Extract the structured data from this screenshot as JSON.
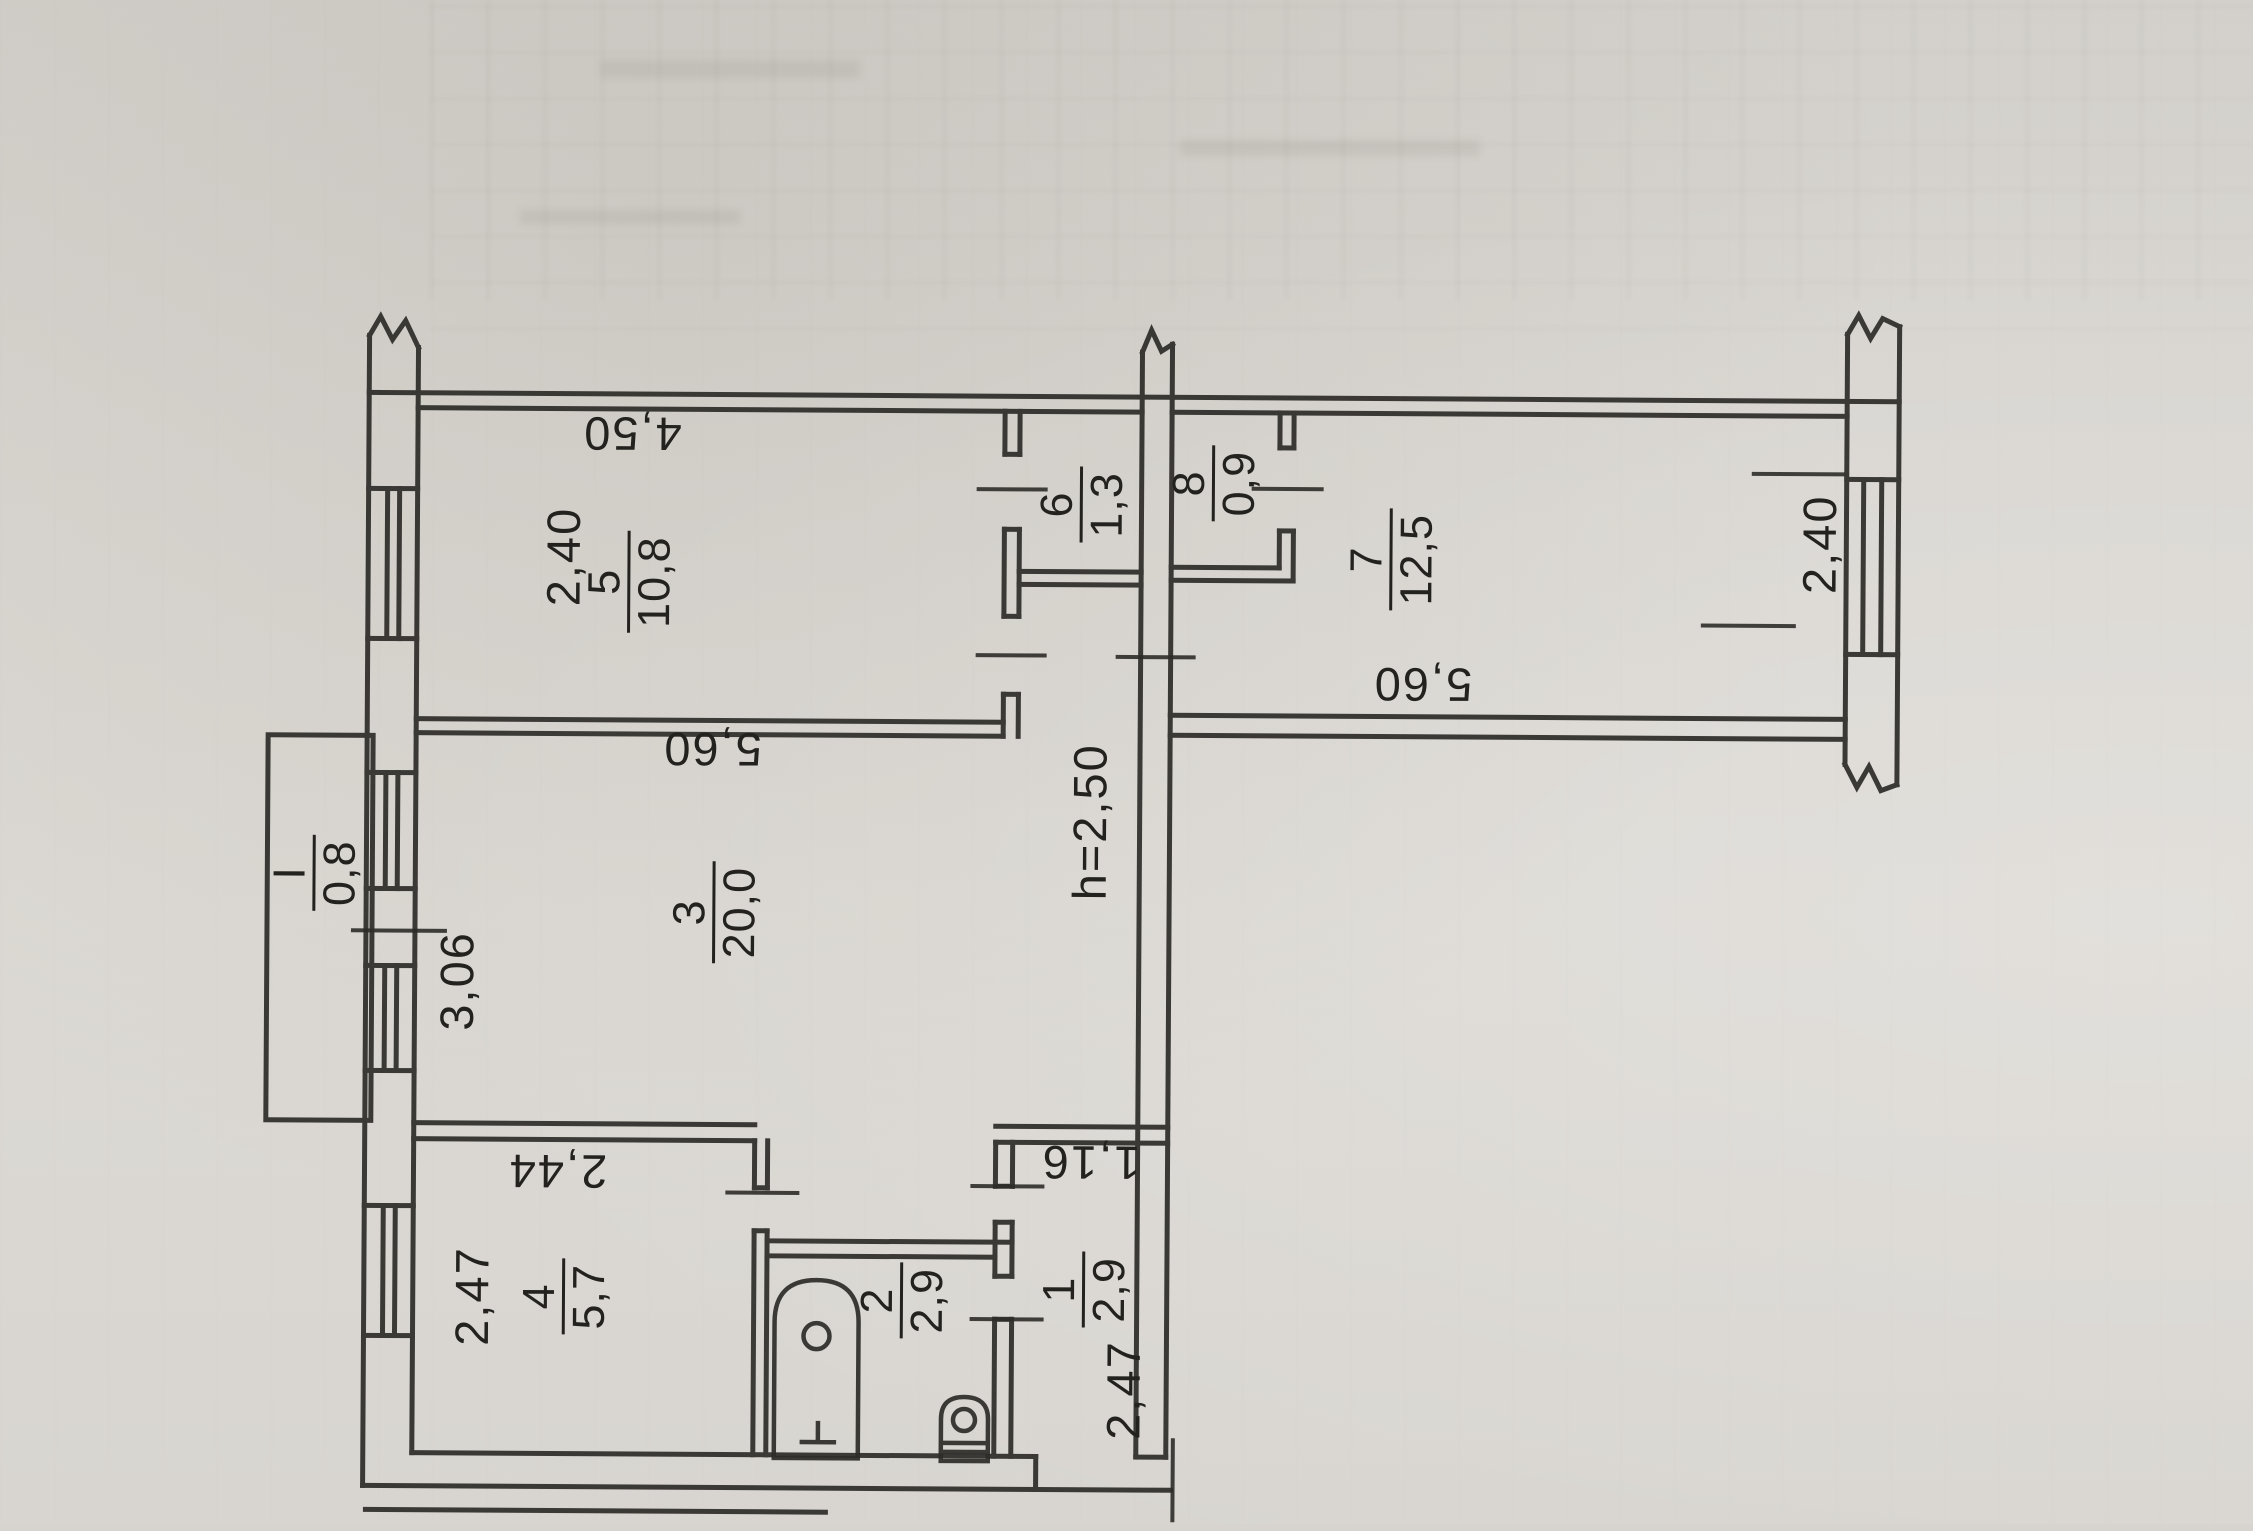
{
  "plan": {
    "rooms": [
      {
        "num": "5",
        "area": "10,8"
      },
      {
        "num": "6",
        "area": "1,3"
      },
      {
        "num": "8",
        "area": "0,9"
      },
      {
        "num": "7",
        "area": "12,5"
      },
      {
        "num": "3",
        "area": "20,0"
      },
      {
        "num": "4",
        "area": "5,7"
      },
      {
        "num": "2",
        "area": "2,9"
      },
      {
        "num": "1",
        "area": "2,9"
      },
      {
        "num": "I",
        "area": "0,8"
      }
    ],
    "dims": [
      {
        "text": "4,50"
      },
      {
        "text": "2,40"
      },
      {
        "text": "5,60"
      },
      {
        "text": "3,06"
      },
      {
        "text": "h=2,50"
      },
      {
        "text": "5,60"
      },
      {
        "text": "2,40"
      },
      {
        "text": "2,44"
      },
      {
        "text": "2,47"
      },
      {
        "text": "1,16"
      },
      {
        "text": "2,47"
      }
    ]
  }
}
